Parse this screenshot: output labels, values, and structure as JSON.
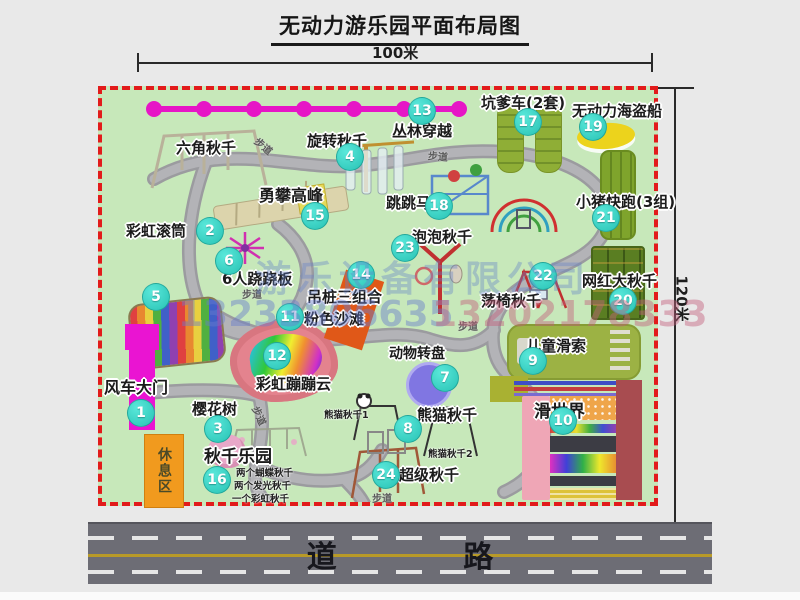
{
  "title": "无动力游乐园平面布局图",
  "dimensions": {
    "width_label": "100米",
    "height_label": "120米"
  },
  "walkway_label": "步道",
  "rest_area_label": "休息区",
  "road_label": "道 路",
  "watermark": {
    "company": "游乐设备有限公司",
    "phone1": "13233806635",
    "phone2": "13202178333"
  },
  "attractions": [
    {
      "num": "1",
      "label": "风车大门"
    },
    {
      "num": "2",
      "label": "六角秋千"
    },
    {
      "num": "3",
      "label": "樱花树"
    },
    {
      "num": "4",
      "label": "旋转秋千"
    },
    {
      "num": "5",
      "label": "彩虹滚筒"
    },
    {
      "num": "6",
      "label": "6人跷跷板"
    },
    {
      "num": "7",
      "label": "动物转盘"
    },
    {
      "num": "8",
      "label": "熊猫秋千",
      "sub1": "熊猫秋千1",
      "sub2": "熊猫秋千2"
    },
    {
      "num": "9",
      "label": "儿童滑索"
    },
    {
      "num": "10",
      "label": "滑世界"
    },
    {
      "num": "11",
      "label": "粉色沙滩"
    },
    {
      "num": "12",
      "label": "彩虹蹦蹦云"
    },
    {
      "num": "13",
      "label": "丛林穿越"
    },
    {
      "num": "14",
      "label": "吊桩三组合"
    },
    {
      "num": "15",
      "label": "勇攀高峰"
    },
    {
      "num": "16",
      "label": "秋千乐园",
      "sub1": "两个蝴蝶秋千",
      "sub2": "两个发光秋千",
      "sub3": "一个彩虹秋千"
    },
    {
      "num": "17",
      "label": "坑爹车(2套)"
    },
    {
      "num": "18",
      "label": "跳跳马"
    },
    {
      "num": "19",
      "label": "无动力海盗船"
    },
    {
      "num": "20",
      "label": "网红大秋千"
    },
    {
      "num": "21",
      "label": "小猪快跑(3组)"
    },
    {
      "num": "22",
      "label": "荡椅秋千"
    },
    {
      "num": "23",
      "label": "泡泡秋千"
    },
    {
      "num": "24",
      "label": "超级秋千"
    }
  ],
  "colors": {
    "map_bg": "#c7e8ba",
    "border_red": "#e21b1b",
    "badge_teal": "#35d6c8",
    "cable_magenta": "#e616c6",
    "gate_magenta": "#ea14d2",
    "road_gray": "#6d6d75"
  }
}
